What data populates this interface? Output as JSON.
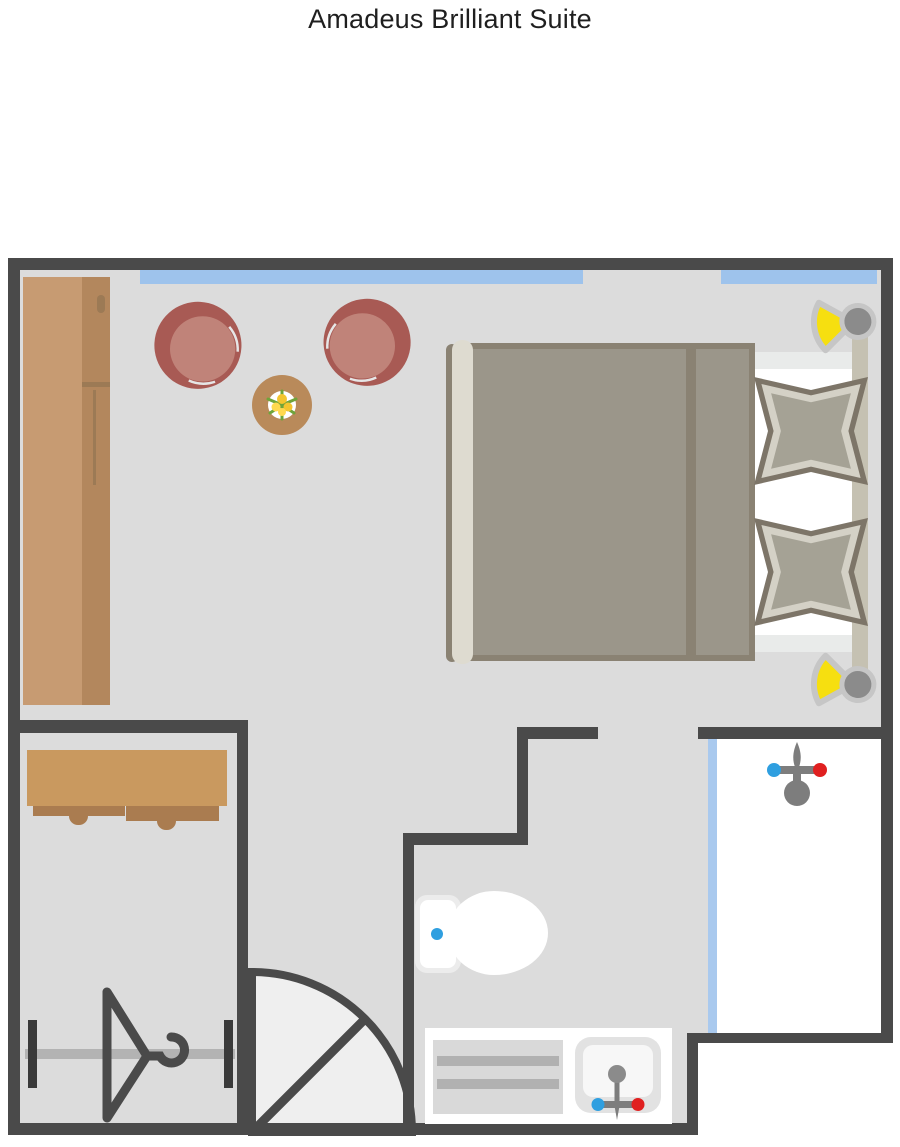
{
  "title": "Amadeus Brilliant Suite",
  "plan": {
    "type": "hotel-suite-floor-plan",
    "rooms": [
      "bedroom-living-area",
      "walk-in-closet",
      "toilet-room",
      "shower-room",
      "entry-hall"
    ],
    "furniture_icons": [
      "wardrobe",
      "armchair-left",
      "armchair-right",
      "coffee-table-with-flowers",
      "double-bed",
      "duvet",
      "footboard",
      "headboard",
      "pillow-top",
      "pillow-bottom",
      "bedside-lamp-top",
      "bedside-lamp-bottom",
      "desk-with-drawers",
      "clothes-rail-with-hanger",
      "entry-door-swing",
      "toilet",
      "vanity-counter",
      "towel-shelf",
      "sink-basin",
      "sink-faucet",
      "shower-faucet",
      "shower-glass-door",
      "window-strip-left",
      "window-strip-right"
    ]
  },
  "colors": {
    "title_color": "#1f1f1f",
    "wall": "#4a4a4a",
    "floor": "#dcdcdc",
    "window_glass": "#9ec3ec",
    "window_edge": "#7ea9d8",
    "shower_glass": "#a9c9ee",
    "wardrobe_light": "#c79b72",
    "wardrobe_dark": "#b3875d",
    "wardrobe_detail": "#9c7a55",
    "desk": "#c9995f",
    "drawer": "#aa7c50",
    "chair_back": "#a85a54",
    "chair_seat": "#c08379",
    "table": "#b98a5a",
    "leaf_green": "#6fa43a",
    "flower_yellow": "#f3c52e",
    "flower_yellow_light": "#ffd94f",
    "duvet": "#9b968a",
    "duvet_border": "#8a8273",
    "sheet_shade": "#e9ebea",
    "footboard": "#dedbd0",
    "headboard": "#c5c1b2",
    "pillow_border": "#7d7568",
    "pillow_light": "#d4d1c6",
    "pillow_fill": "#a5a295",
    "lamp_yellow": "#f6df10",
    "lamp_gray": "#8b8b8b",
    "lamp_ring": "#c6c6c6",
    "swing": "#efefef",
    "rail": "#b3b3b3",
    "rail_end": "#3a3a3a",
    "hanger": "#4a4a4a",
    "fixture_gray": "#7d7d7d",
    "cold_blue": "#2f9fe0",
    "hot_red": "#e02020",
    "shelf_gray": "#d9d9d9",
    "towel_stripe": "#b1b1b1",
    "sink_rim": "#e2e2e2",
    "white": "#ffffff"
  }
}
